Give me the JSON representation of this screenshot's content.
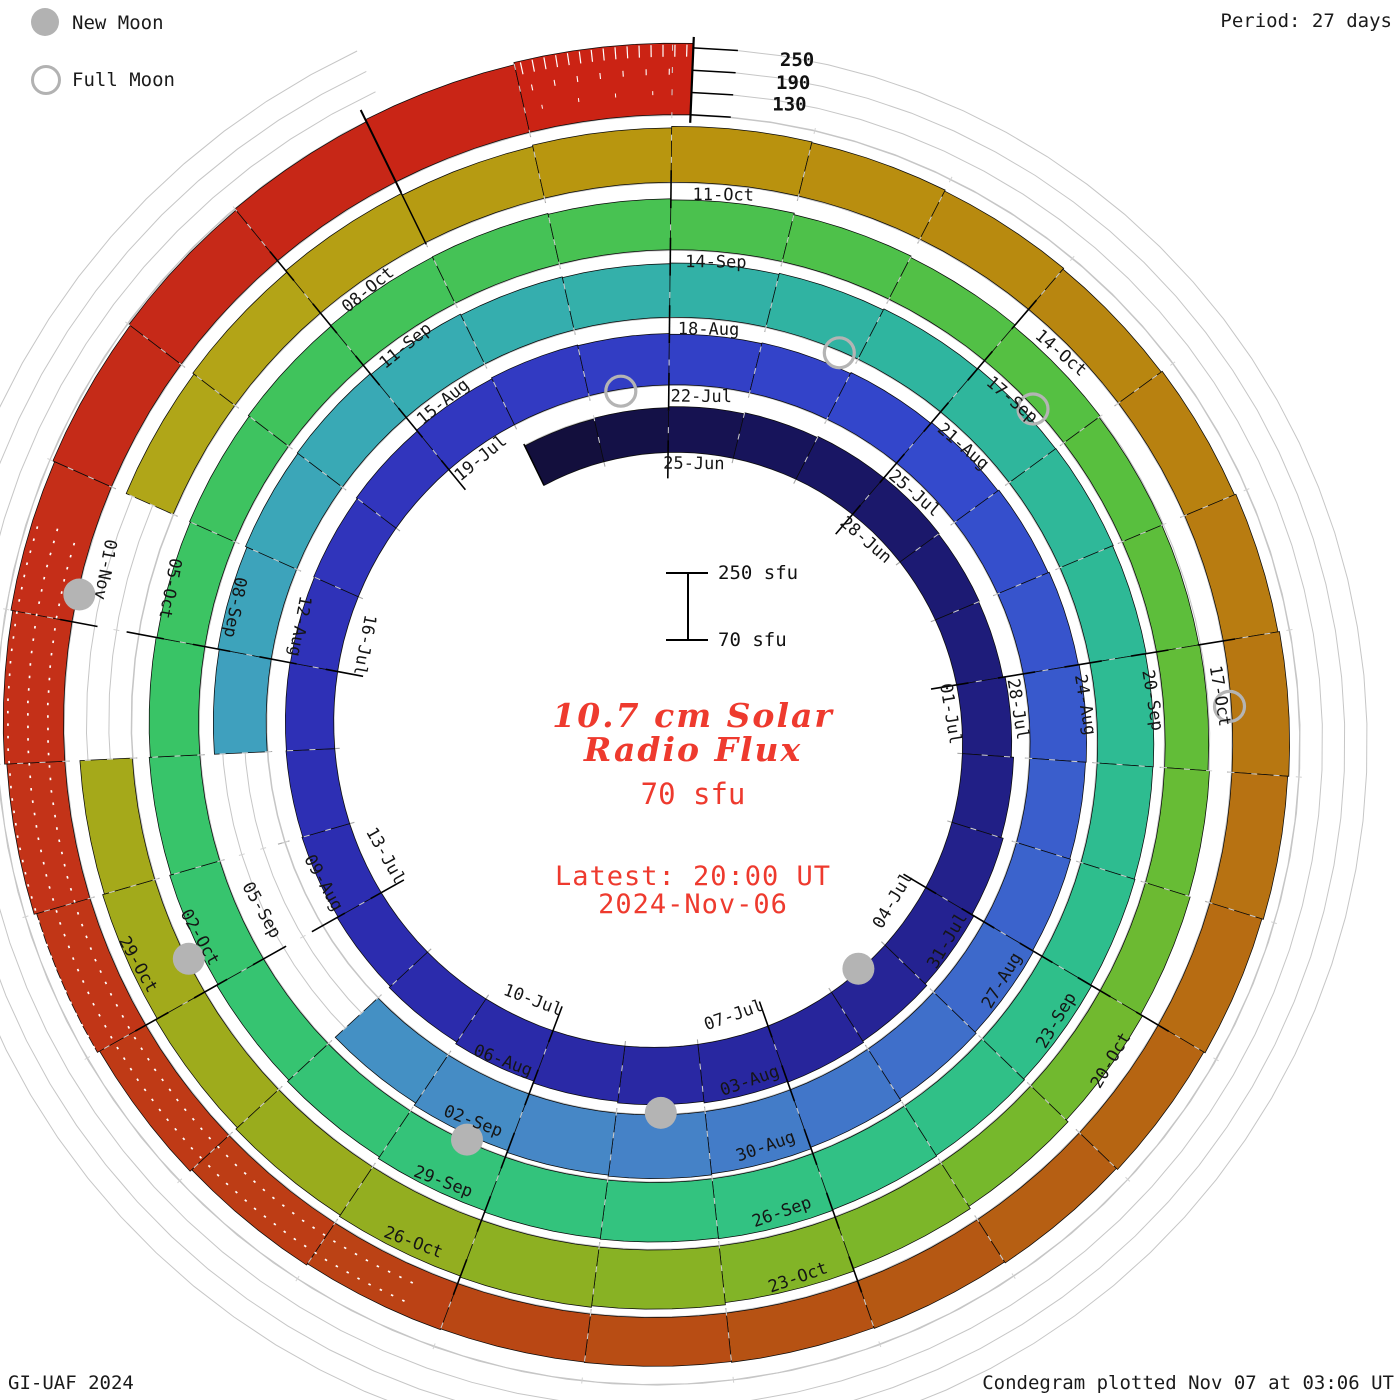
{
  "legend": {
    "new_moon": "New Moon",
    "full_moon": "Full Moon"
  },
  "period_note": "Period: 27 days",
  "footer": {
    "left": "GI-UAF 2024",
    "right": "Condegram plotted Nov 07 at 03:06 UT"
  },
  "scale_bar": {
    "top": "250 sfu",
    "bottom": "70 sfu"
  },
  "center_text": {
    "title_line1": "10.7 cm Solar",
    "title_line2": "Radio Flux",
    "subtitle": "70 sfu",
    "latest_label": "Latest: 20:00 UT",
    "latest_date": "2024-Nov-06"
  },
  "chart_data": {
    "type": "spiral_bar_condegram",
    "title": "10.7 cm Solar Radio Flux",
    "unit": "sfu",
    "period_days": 27,
    "baseline_sfu": 70,
    "max_scale_sfu": 250,
    "radial_gridlines_sfu": [
      130,
      190,
      250
    ],
    "radial_scale_labels": [
      "250",
      "190",
      "130"
    ],
    "start_date": "2024-06-23",
    "end_date": "2024-11-06",
    "plotted": "Nov 07 at 03:06 UT",
    "dates_note": "daily F10.7 values, 2024-06-23 through 2024-11-06; nulls are data gaps",
    "values": [
      188,
      190,
      193,
      196,
      199,
      200,
      198,
      196,
      202,
      208,
      214,
      220,
      226,
      230,
      228,
      224,
      220,
      215,
      210,
      206,
      203,
      201,
      200,
      199,
      201,
      204,
      207,
      210,
      208,
      206,
      208,
      211,
      214,
      217,
      220,
      222,
      220,
      222,
      225,
      229,
      234,
      238,
      241,
      238,
      233,
      226,
      null,
      null,
      null,
      212,
      216,
      220,
      222,
      219,
      216,
      214,
      216,
      219,
      222,
      224,
      225,
      223,
      221,
      220,
      222,
      225,
      228,
      230,
      232,
      230,
      228,
      224,
      219,
      214,
      210,
      206,
      203,
      201,
      203,
      206,
      208,
      209,
      207,
      204,
      200,
      196,
      191,
      187,
      185,
      187,
      191,
      196,
      202,
      209,
      216,
      223,
      229,
      233,
      230,
      226,
      221,
      216,
      211,
      null,
      null,
      208,
      212,
      217,
      212,
      216,
      220,
      218,
      215,
      212,
      215,
      219,
      223,
      220,
      216,
      212,
      208,
      205,
      203,
      201,
      200,
      202,
      206,
      212,
      219,
      226,
      232,
      237,
      242,
      246,
      250,
      256,
      262
    ],
    "date_labels": [
      {
        "d": 4,
        "label": "25-Jun"
      },
      {
        "d": 7,
        "label": "28-Jun"
      },
      {
        "d": 10,
        "label": "01-Jul"
      },
      {
        "d": 13,
        "label": "04-Jul"
      },
      {
        "d": 16,
        "label": "07-Jul"
      },
      {
        "d": 19,
        "label": "10-Jul"
      },
      {
        "d": 22,
        "label": "13-Jul"
      },
      {
        "d": 25,
        "label": "16-Jul"
      },
      {
        "d": 28,
        "label": "19-Jul"
      },
      {
        "d": 31,
        "label": "22-Jul"
      },
      {
        "d": 34,
        "label": "25-Jul"
      },
      {
        "d": 37,
        "label": "28-Jul"
      },
      {
        "d": 40,
        "label": "31-Jul"
      },
      {
        "d": 43,
        "label": "03-Aug"
      },
      {
        "d": 46,
        "label": "06-Aug"
      },
      {
        "d": 49,
        "label": "09-Aug"
      },
      {
        "d": 52,
        "label": "12-Aug"
      },
      {
        "d": 55,
        "label": "15-Aug"
      },
      {
        "d": 58,
        "label": "18-Aug"
      },
      {
        "d": 61,
        "label": "21-Aug"
      },
      {
        "d": 64,
        "label": "24-Aug"
      },
      {
        "d": 67,
        "label": "27-Aug"
      },
      {
        "d": 70,
        "label": "30-Aug"
      },
      {
        "d": 73,
        "label": "02-Sep"
      },
      {
        "d": 76,
        "label": "05-Sep"
      },
      {
        "d": 79,
        "label": "08-Sep"
      },
      {
        "d": 82,
        "label": "11-Sep"
      },
      {
        "d": 85,
        "label": "14-Sep"
      },
      {
        "d": 88,
        "label": "17-Sep"
      },
      {
        "d": 91,
        "label": "20-Sep"
      },
      {
        "d": 94,
        "label": "23-Sep"
      },
      {
        "d": 97,
        "label": "26-Sep"
      },
      {
        "d": 100,
        "label": "29-Sep"
      },
      {
        "d": 103,
        "label": "02-Oct"
      },
      {
        "d": 106,
        "label": "05-Oct"
      },
      {
        "d": 109,
        "label": "08-Oct"
      },
      {
        "d": 112,
        "label": "11-Oct"
      },
      {
        "d": 115,
        "label": "14-Oct"
      },
      {
        "d": 118,
        "label": "17-Oct"
      },
      {
        "d": 121,
        "label": "20-Oct"
      },
      {
        "d": 124,
        "label": "23-Oct"
      },
      {
        "d": 127,
        "label": "26-Oct"
      },
      {
        "d": 130,
        "label": "29-Oct"
      },
      {
        "d": 133,
        "label": "01-Nov"
      }
    ],
    "new_moons": [
      {
        "date": "2024-07-05",
        "d": 14.5
      },
      {
        "date": "2024-08-04",
        "d": 44.5
      },
      {
        "date": "2024-09-03",
        "d": 73.4
      },
      {
        "date": "2024-10-02",
        "d": 103.3
      },
      {
        "date": "2024-11-01",
        "d": 133.2
      }
    ],
    "full_moons": [
      {
        "date": "2024-07-21",
        "d": 30.4
      },
      {
        "date": "2024-08-19",
        "d": 59.8
      },
      {
        "date": "2024-09-18",
        "d": 88.6
      },
      {
        "date": "2024-10-17",
        "d": 118.5
      }
    ],
    "color_stops": [
      [
        2,
        "#120e38"
      ],
      [
        6,
        "#181560"
      ],
      [
        10,
        "#1f1d7e"
      ],
      [
        16,
        "#28269e"
      ],
      [
        22,
        "#2c2cb0"
      ],
      [
        28,
        "#3136be"
      ],
      [
        34,
        "#3347cc"
      ],
      [
        40,
        "#3c66cc"
      ],
      [
        45,
        "#4685c6"
      ],
      [
        50,
        "#429bc2"
      ],
      [
        55,
        "#38abb4"
      ],
      [
        60,
        "#2fb4a0"
      ],
      [
        66,
        "#2ebd8e"
      ],
      [
        72,
        "#33c37e"
      ],
      [
        78,
        "#38c468"
      ],
      [
        84,
        "#46c254"
      ],
      [
        90,
        "#5abf3c"
      ],
      [
        96,
        "#79b72a"
      ],
      [
        102,
        "#9cab1c"
      ],
      [
        108,
        "#b2a618"
      ],
      [
        112,
        "#b9940e"
      ],
      [
        116,
        "#b88410"
      ],
      [
        120,
        "#b76f12"
      ],
      [
        124,
        "#b55513"
      ],
      [
        128,
        "#bc3f15"
      ],
      [
        132,
        "#c43118"
      ],
      [
        136,
        "#c62818"
      ],
      [
        139.2,
        "#cc2113"
      ]
    ],
    "gaps": [
      "2024-08-08 to 2024-08-10",
      "2024-10-04 to 2024-10-05"
    ],
    "hourly_hatch_day_range": [
      138,
      139.13
    ],
    "white_dash_overlay_range": [
      127.3,
      133.6
    ],
    "end_day": 139.13
  }
}
